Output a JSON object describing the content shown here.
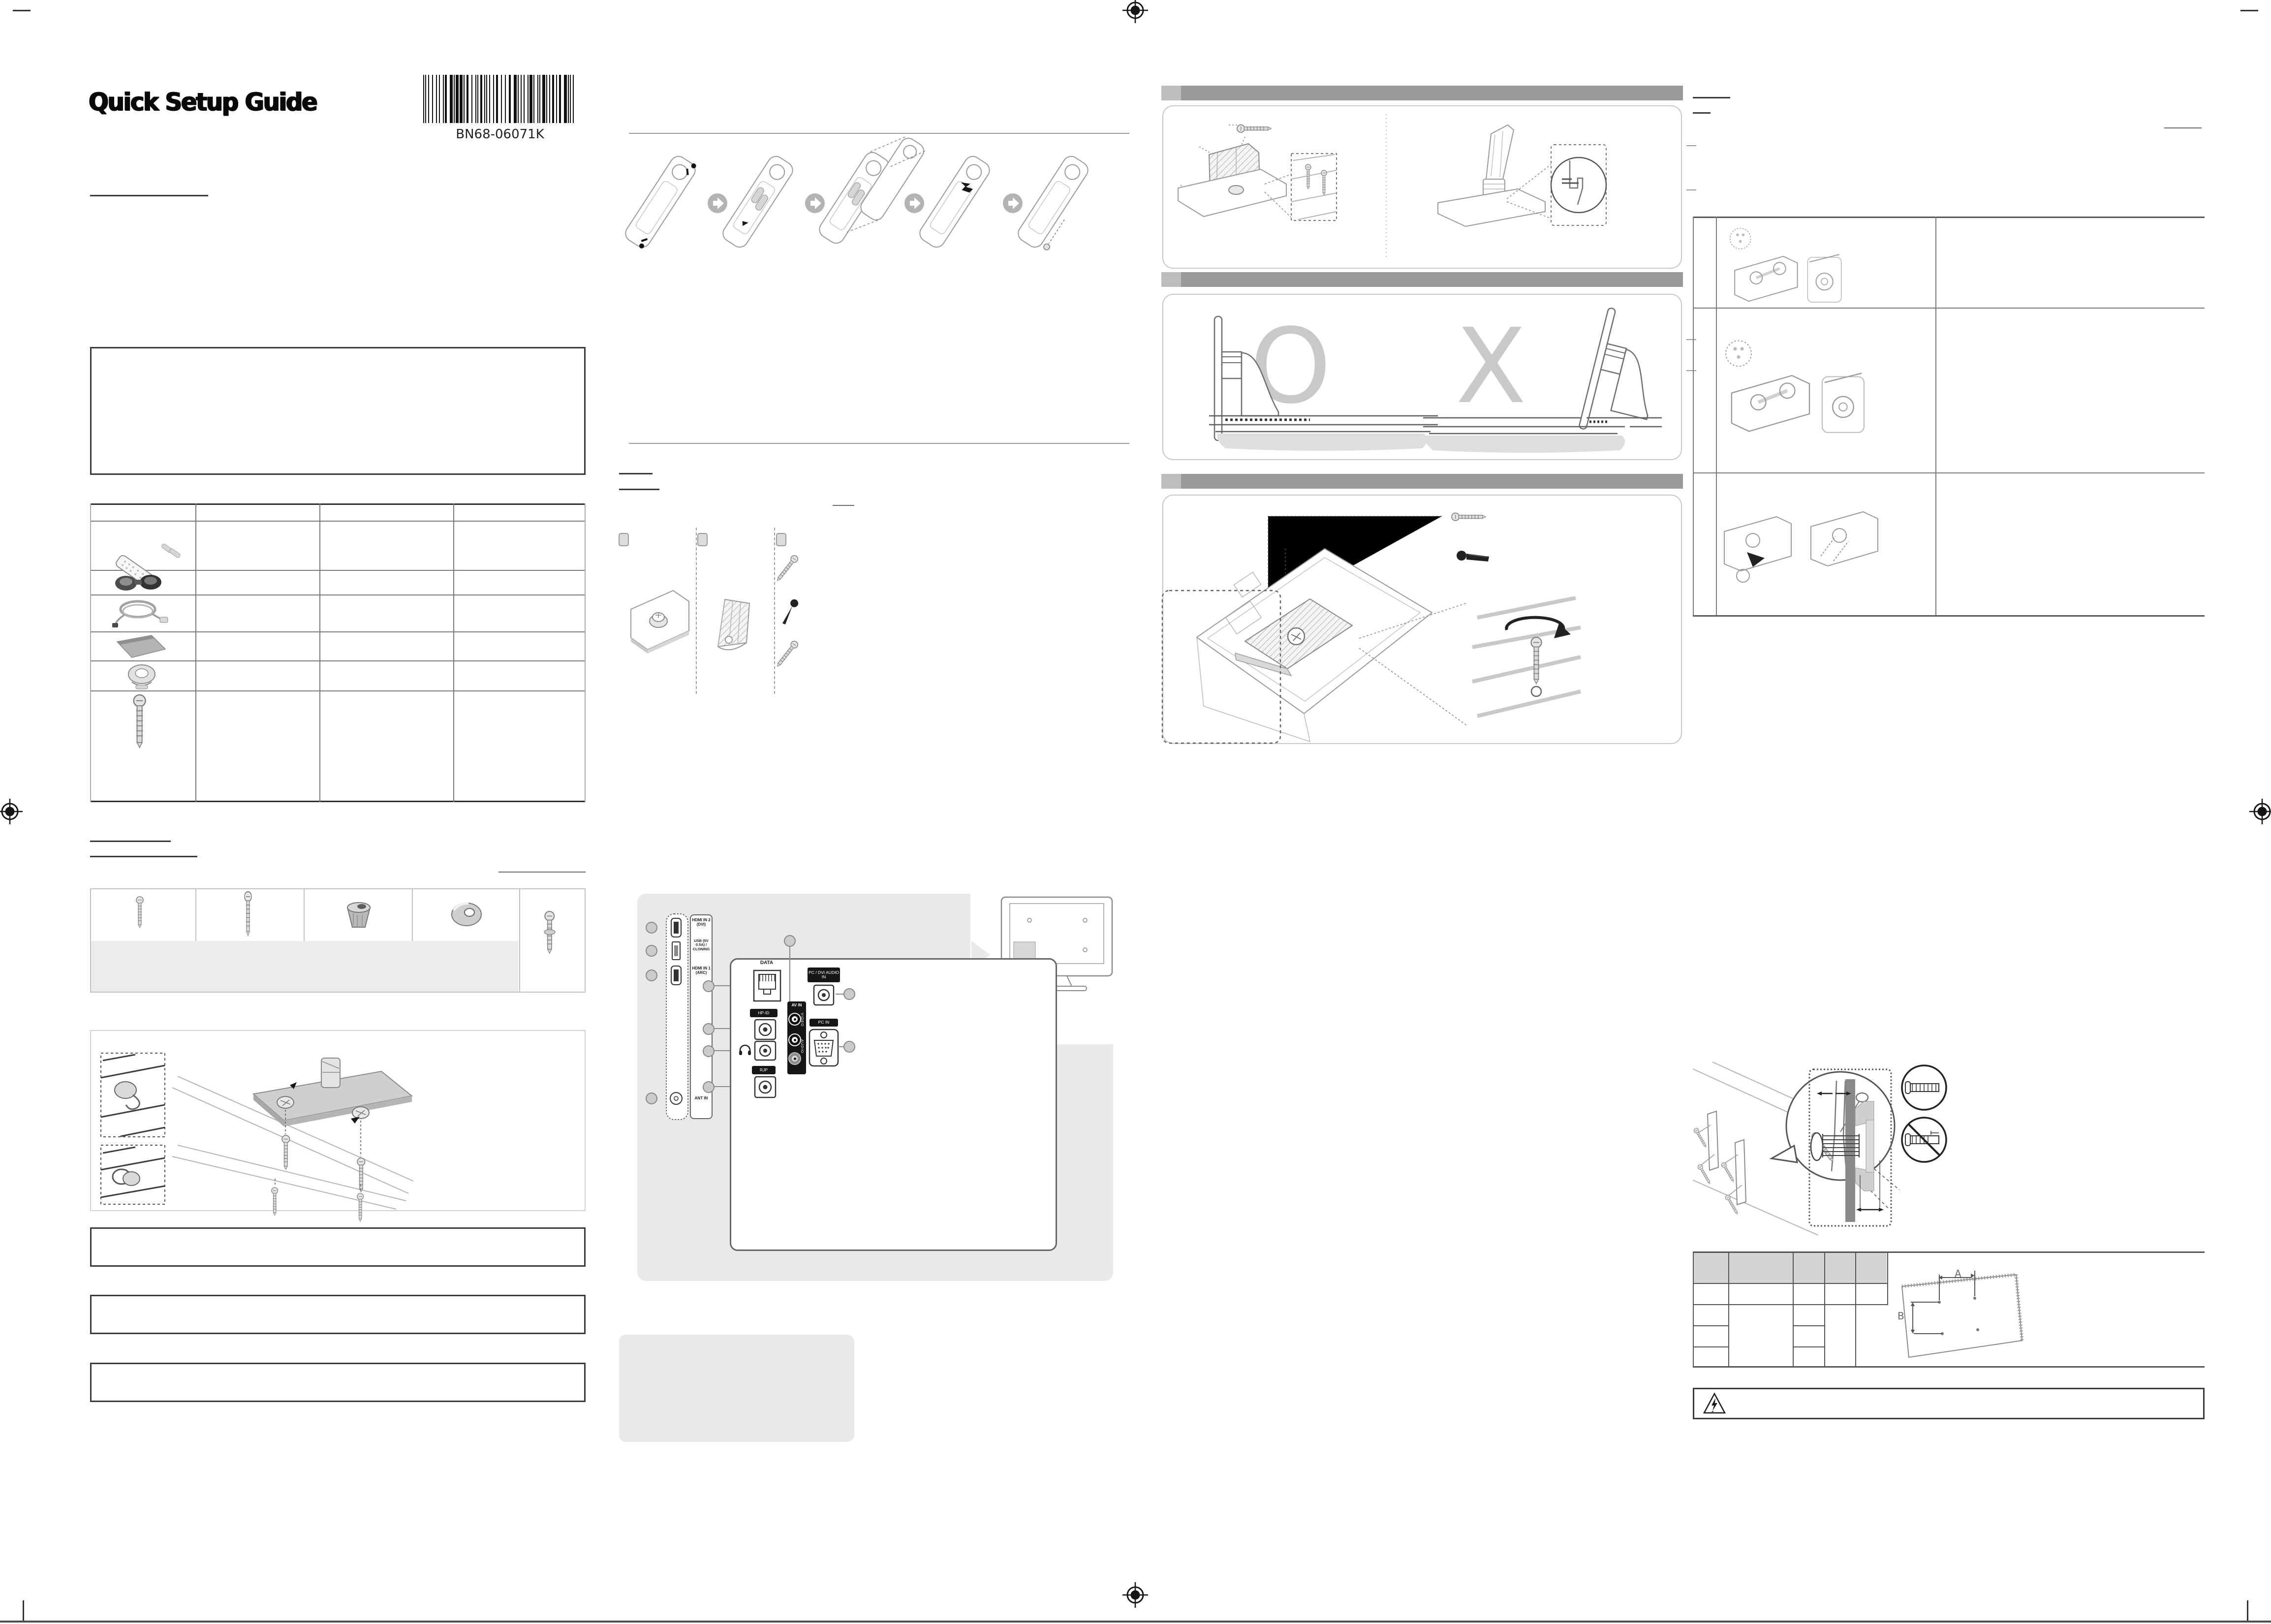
{
  "document": {
    "title": "Quick Setup Guide",
    "barcode_text": "BN68-06071K"
  },
  "placement_check": {
    "correct_mark": "O",
    "incorrect_mark": "X"
  },
  "connections": {
    "side_panel": {
      "hdmi2": "HDMI IN 2 (DVI)",
      "usb": "USB (5V 0.5A) / CLONING",
      "hdmi1": "HDMI IN 1 (ARC)",
      "ant": "ANT IN"
    },
    "rear_panel": {
      "data": "DATA",
      "hp_id": "HP-ID",
      "rjp": "RJP",
      "av_in": "AV IN",
      "video": "VIDEO",
      "audio": "AUDIO",
      "pc_dvi_audio_in": "PC / DVI AUDIO IN",
      "pc_in": "PC IN"
    }
  },
  "wall_mount": {
    "dim_a": "A",
    "dim_b": "B"
  }
}
